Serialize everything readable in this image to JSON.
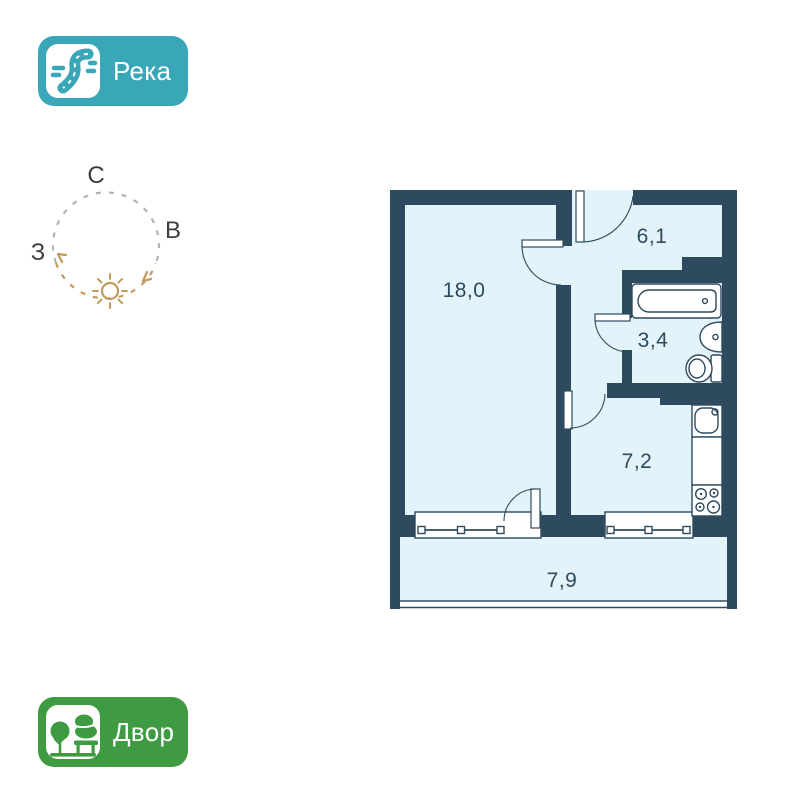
{
  "river_badge": {
    "label": "Река",
    "bg_color": "#3aa7b9",
    "icon": "river-icon"
  },
  "yard_badge": {
    "label": "Двор",
    "bg_color": "#3f9b42",
    "icon": "trees-bench-icon"
  },
  "compass": {
    "north": "С",
    "east": "В",
    "west": "З",
    "ring_color": "#b3b3b3",
    "sun_color": "#c49a5c",
    "letter_color": "#3d3d3d"
  },
  "floorplan": {
    "wall_color": "#2e4a5f",
    "floor_color": "#e2f3f9",
    "rooms": [
      {
        "name": "living-room",
        "area": "18,0"
      },
      {
        "name": "hallway",
        "area": "6,1"
      },
      {
        "name": "bathroom",
        "area": "3,4"
      },
      {
        "name": "kitchen",
        "area": "7,2"
      },
      {
        "name": "balcony",
        "area": "7,9"
      }
    ],
    "fixtures": [
      "bathtub",
      "wash-basin",
      "toilet",
      "kitchen-sink",
      "counter",
      "stove"
    ]
  }
}
